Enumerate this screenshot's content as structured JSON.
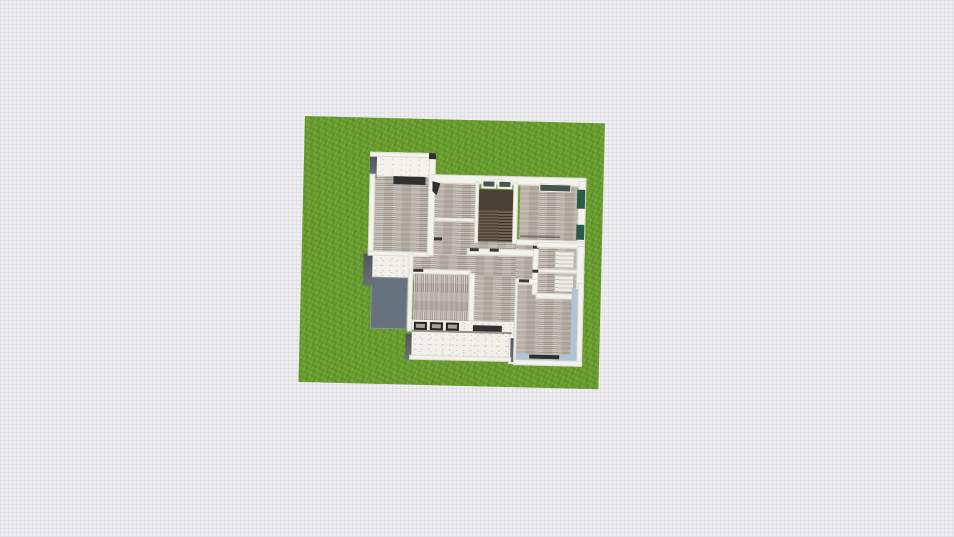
{
  "app": {
    "view": "floor-plan-top-down-3d",
    "visible_text": ""
  },
  "colors": {
    "canvas_bg": "#efeef1",
    "grid_line": "#e1e0e7",
    "grass": "#6ca02f",
    "wall": "#f4f2ed",
    "wall_dark_side": "#4f565c",
    "floor": "#c1b9b1",
    "porch": "#f2f0ea",
    "patio": "#66727d",
    "stair_dark": "#4b4034",
    "stair_step": "#6e5f50",
    "stair_line": "#3c332b",
    "window_dark": "#49544f",
    "green_wall": "#2b5c49",
    "blue_wall": "#afc5d3",
    "dark_item": "#30302e",
    "fixture": "#efede7",
    "fixture_line": "#b9b6ae"
  },
  "scene": {
    "lot_surface": "grass",
    "rooms": [
      "bedroom-top-left",
      "hall-room-top",
      "bathroom-small",
      "staircase",
      "bedroom-top-right",
      "closet-upper",
      "closet-lower",
      "hallway",
      "kitchen",
      "bedroom-bottom-right",
      "entry-porch",
      "patio",
      "veranda"
    ],
    "furniture": [
      "dresser",
      "open-door",
      "stair-flight",
      "skylight-window-pair",
      "window-top-right",
      "wardrobe-green-panels",
      "vanity-upper",
      "vanity-lower",
      "stove-burners",
      "bench",
      "window-sill",
      "window-seat"
    ]
  }
}
